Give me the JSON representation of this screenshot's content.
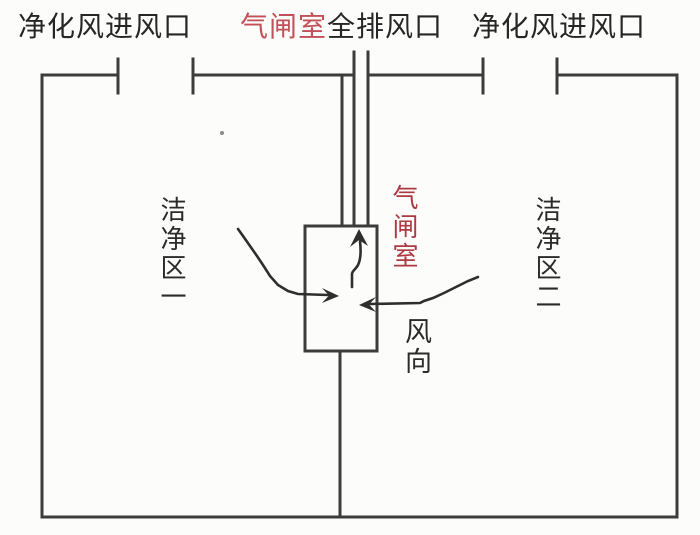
{
  "diagram": {
    "description": "cleanroom-airlock-airflow-schematic",
    "labels": {
      "top_left": "净化风进风口",
      "top_center_red": "气闸室",
      "top_center_black": "全排风口",
      "top_right": "净化风进风口",
      "zone_left": "洁净区一",
      "zone_right": "洁净区二",
      "airlock": "气闸室",
      "wind_direction": "风向"
    },
    "colors": {
      "wall_line": "#3c3c3c",
      "arrow_line": "#2e2e2e",
      "text_black": "#262626",
      "text_red_top": "#c2505a",
      "text_red_airlock": "#ad3a42",
      "background": "#fcfcfb"
    }
  }
}
